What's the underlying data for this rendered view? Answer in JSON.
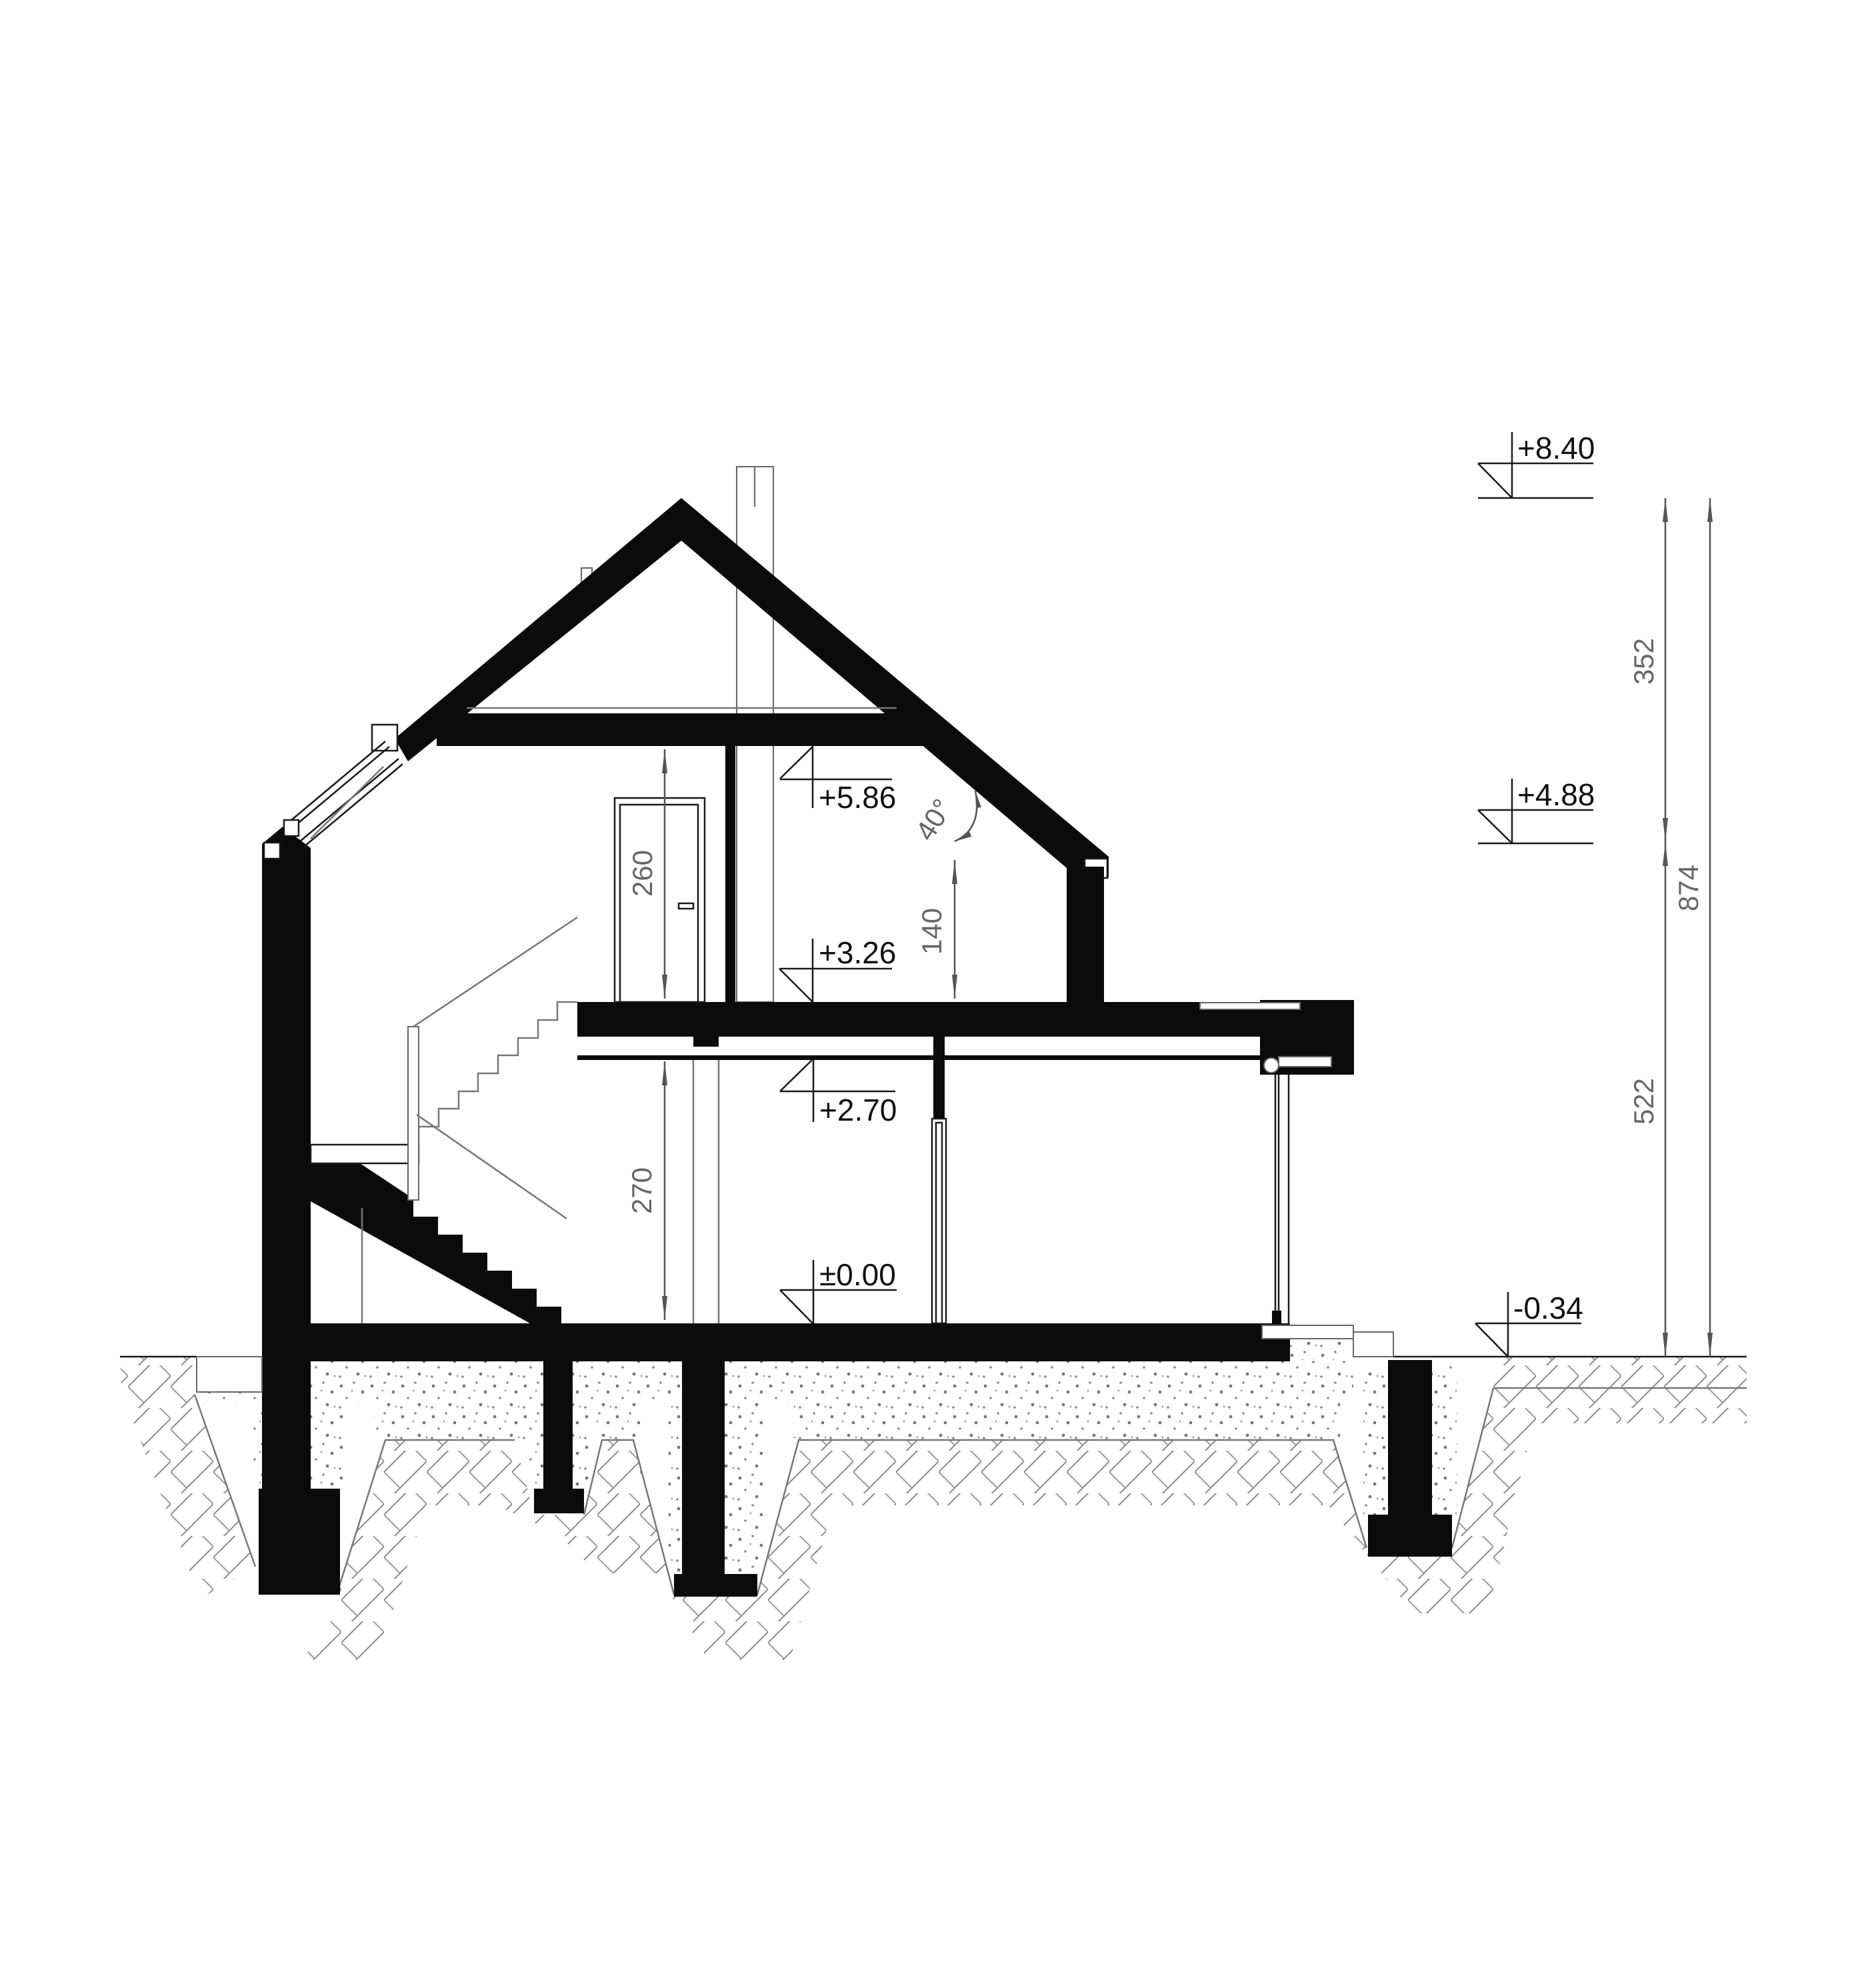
{
  "drawing": {
    "kind": "house cross-section",
    "colors": {
      "ink": "#0b0b0b",
      "dim_gray": "#666666",
      "paper": "#ffffff"
    },
    "elevation_markers": {
      "ridge": {
        "label": "+8.40"
      },
      "eaves_right": {
        "label": "+4.88"
      },
      "terrain": {
        "label": "-0.34"
      },
      "attic_ceiling": {
        "label": "+5.86"
      },
      "attic_floor": {
        "label": "+3.26"
      },
      "ground_ceiling": {
        "label": "+2.70"
      },
      "ground_floor": {
        "label": "±0.00"
      }
    },
    "dimensions": {
      "roof_zone_height": {
        "value": "352"
      },
      "total_height": {
        "value": "874"
      },
      "wall_zone_height": {
        "value": "522"
      },
      "attic_room_height": {
        "value": "260"
      },
      "knee_wall_height": {
        "value": "140"
      },
      "ground_room_height": {
        "value": "270"
      },
      "roof_pitch_angle": {
        "value": "40°"
      }
    }
  }
}
